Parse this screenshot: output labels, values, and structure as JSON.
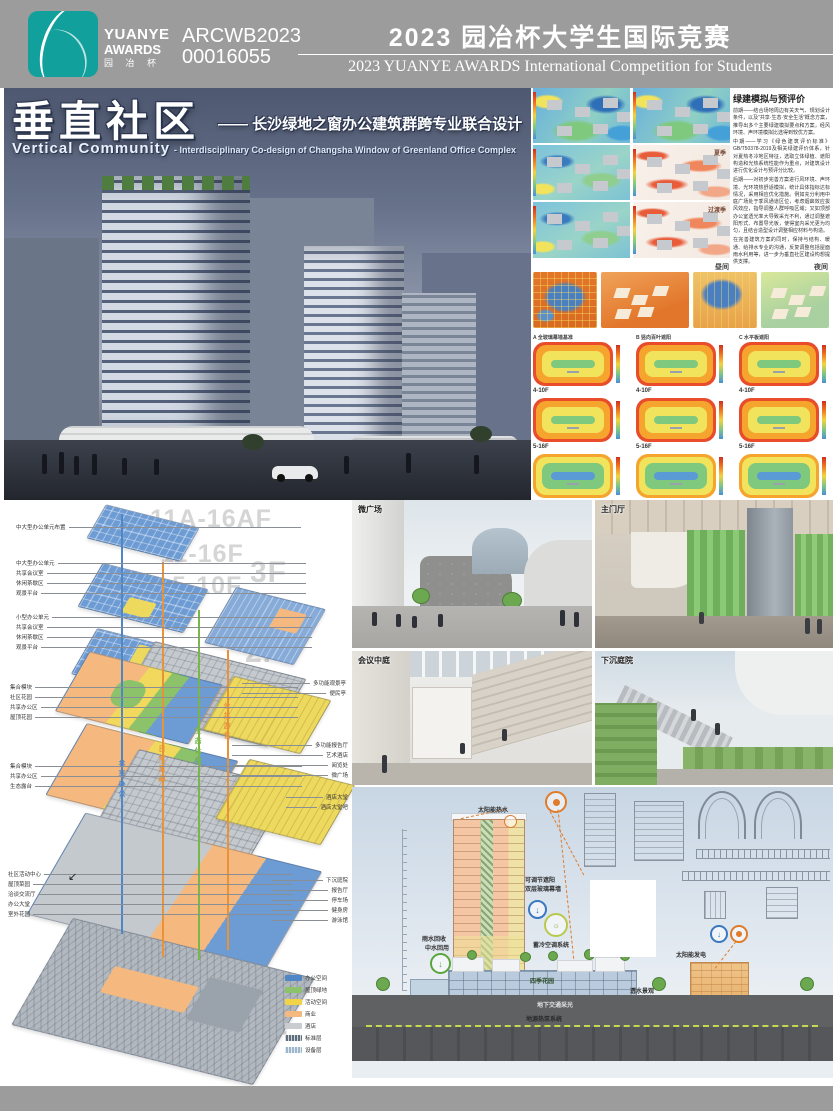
{
  "brand_color": "#12a09c",
  "header": {
    "logo": {
      "line1": "YUANYE",
      "line2": "AWARDS",
      "line3": "园 冶 杯"
    },
    "entry_id": {
      "line1": "ARCWB2023",
      "line2": "00016055"
    },
    "title_cn": "2023 园冶杯大学生国际竞赛",
    "title_en": "2023 YUANYE AWARDS International Competition for  Students"
  },
  "hero": {
    "title_cn": "垂直社区",
    "subtitle_cn": "—— 长沙绿地之窗办公建筑群跨专业联合设计",
    "title_en": "Vertical Community",
    "subtitle_en": "- Interdisciplinary Co-design of Changsha Window of Greenland Office Complex"
  },
  "green_sim": {
    "title": "绿建模拟与预评价",
    "paragraphs": [
      "前期——结合场地周边有关天气、规划设计条件，以及“共享·生态·安全生活”概念方案，推导出多个主要绿建模拟要点和方案，经风环境、声环境模拟比选得到较优方案。",
      "中期——学习《绿色建筑评价标准》GB/T50378-2019及相关绿建评价体系，针对夏热冬冷地区特征，选取立体绿植、遮阳构造和光热系统性能作为重点，对建筑设计进行优化设计与预评分比较。",
      "后期——对初步完善方案进行风环境、声环境、光环境热舒适模拟，统计具体指标达标情况，采用相应优化措施。例如充分利用中庭广场处于季风通道区位，考虑烟囱效应拔风效应，指导调整人群呼吸区域；又如顶部办公室透光率大导致采光不利，通过调整遮阳形式、布置导光板，使得室内采光更为均匀，且结合造型设计调整相应材料与构造。",
      "在完善建筑方案的同时，保持与结构、暖通、给排水专业的沟通，反复调整包括屋面雨水利用等，进一步为垂直社区建设构想提供支撑。"
    ],
    "wind_labels": {
      "summer": "夏季",
      "transition": "过渡季"
    },
    "thermal_labels": {
      "day": "昼间",
      "night": "夜间"
    },
    "schemes": [
      "A 全玻璃幕墙基准",
      "B 竖向百叶遮阳",
      "C 水平板遮阳"
    ],
    "rows": [
      "4-10F",
      "5-16F",
      "5A-16AF标层"
    ]
  },
  "axon": {
    "floors": [
      "11A-16AF",
      "11-16F",
      "5-10F",
      "3F",
      "2F",
      "1F",
      "-2F"
    ],
    "groups": {
      "top": [
        "中大型办公单元布置"
      ],
      "mid1": [
        "中大型办公单元",
        "共享会议室",
        "休闲茶歇区",
        "观景平台"
      ],
      "mid2": [
        "小型办公单元",
        "共享会议室",
        "休闲茶歇区",
        "观景平台"
      ],
      "mid3": [
        "集合模块",
        "社区花园",
        "共享办公区",
        "屋顶花园"
      ],
      "mid4": [
        "集合模块",
        "共享办公区",
        "生态露台"
      ],
      "f1left": [
        "社区活动中心",
        "屋顶菜园",
        "洽谈交流厅",
        "办公大堂",
        "室外花园"
      ],
      "f3right": [
        "多功能观景亭",
        "便民亭"
      ],
      "f2right": [
        "多功能报告厅",
        "艺术酒店",
        "阅览处",
        "微广场"
      ],
      "hotel": [
        "酒店大堂",
        "酒店大堂吧"
      ],
      "f1right": [
        "下沉庭院",
        "报告厅",
        "停车场",
        "健身房",
        "游泳馆"
      ]
    },
    "strips": [
      "共享办公",
      "日常觅趣",
      "生态休闲",
      "公共游艺"
    ],
    "strip_colors": [
      "#4e86c6",
      "#e8923a",
      "#7ab648",
      "#e8923a"
    ],
    "legend": [
      {
        "label": "办公空间",
        "color": "#4e86c6"
      },
      {
        "label": "屋顶绿地",
        "color": "#8cc269"
      },
      {
        "label": "活动空间",
        "color": "#f2d348"
      },
      {
        "label": "商业",
        "color": "#f5b97f"
      },
      {
        "label": "酒店",
        "color": "#c9ccd1"
      },
      {
        "label": "标准层",
        "color": "#5f6e7d"
      },
      {
        "label": "设备层",
        "color": "#9db8cc"
      }
    ]
  },
  "renders": {
    "plaza": "微广场",
    "lobby": "主门厅",
    "atrium": "会议中庭",
    "court": "下沉庭院"
  },
  "section": {
    "solar_water": "太阳能热水",
    "shading1": "可调节遮阳",
    "shading2": "双层玻璃幕墙",
    "rain1": "雨水回收",
    "rain2": "中水回用",
    "hvac": "蓄冷空调系统",
    "solar_pv": "太阳能发电",
    "garden": "四季花园",
    "permeable": "透水景观",
    "underground": "地下交通采光",
    "geothermal": "地源热泵系统"
  }
}
